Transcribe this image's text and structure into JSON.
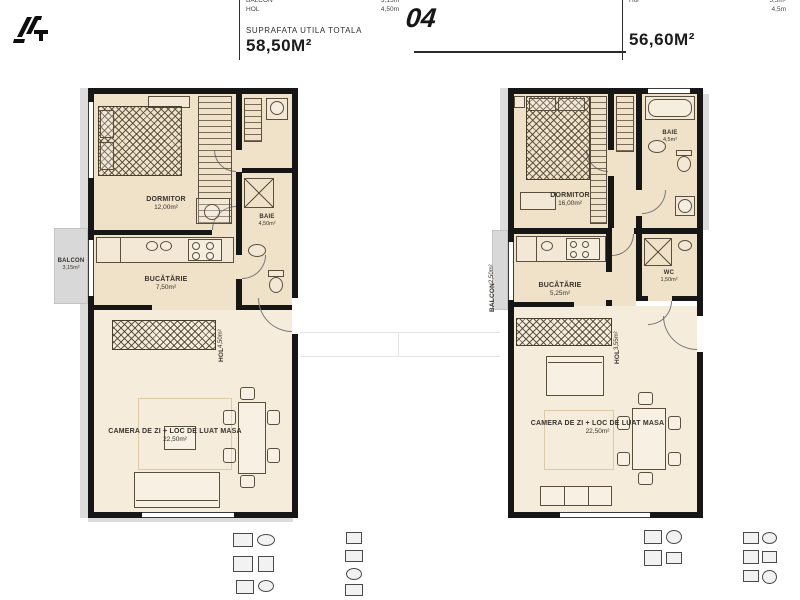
{
  "header": {
    "unit_number": "04",
    "left_legend": {
      "rows": [
        {
          "label": "BALCON",
          "value": "3,15m"
        },
        {
          "label": "HOL",
          "value": "4,50m"
        }
      ],
      "total_label": "SUPRAFATA UTILA TOTALA",
      "total_value": "58,50M²"
    },
    "right_legend": {
      "rows": [
        {
          "label": "Hol",
          "value": "5,5m²"
        },
        {
          "label": "",
          "value": "4,5m"
        }
      ],
      "total_value": "56,60M²"
    }
  },
  "unit_left": {
    "rooms": {
      "dormitor": {
        "name": "DORMITOR",
        "area": "12,00m²"
      },
      "baie": {
        "name": "BAIE",
        "area": "4,50m²"
      },
      "bucatarie": {
        "name": "BUCĂTĂRIE",
        "area": "7,50m²"
      },
      "hol": {
        "name": "HOL",
        "area": "4,50m²"
      },
      "living": {
        "name": "CAMERA DE ZI + LOC DE LUAT MASA",
        "area": "22,50m²"
      },
      "balcon": {
        "name": "BALCON",
        "area": "3,15m²"
      }
    }
  },
  "unit_right": {
    "rooms": {
      "dormitor": {
        "name": "DORMITOR",
        "area": "16,00m²"
      },
      "baie": {
        "name": "BAIE",
        "area": "4,5m²"
      },
      "bucatarie": {
        "name": "BUCĂTĂRIE",
        "area": "5,25m²"
      },
      "wc": {
        "name": "WC",
        "area": "1,50m²"
      },
      "hol": {
        "name": "HOL",
        "area": "3,55m²"
      },
      "living": {
        "name": "CAMERA DE ZI + LOC DE LUAT MASA",
        "area": "22,50m²"
      },
      "balcon": {
        "name": "BALCON",
        "area": "2,50m²"
      }
    }
  },
  "icons": {
    "logo": "dg-monogram"
  },
  "colors": {
    "wall": "#161616",
    "floor": "#f0e2c9",
    "floor_light": "#f5ecdc",
    "balcony_gray": "#d8d8d8"
  }
}
